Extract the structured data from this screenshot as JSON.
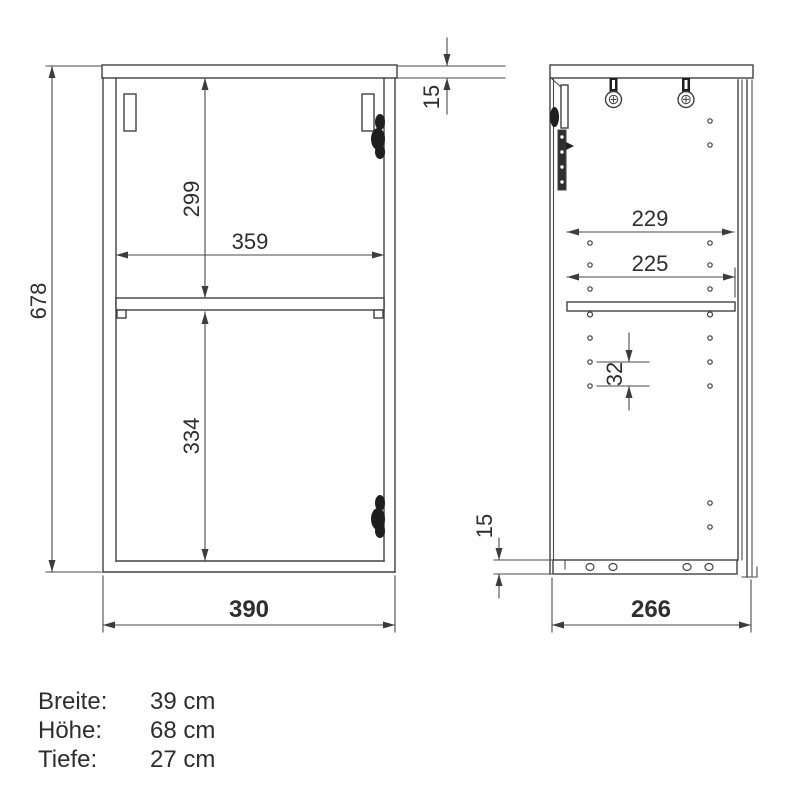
{
  "front_view": {
    "dims": {
      "height": "678",
      "top_panel": "15",
      "upper_section": "299",
      "inner_width": "359",
      "lower_section": "334",
      "width": "390"
    }
  },
  "side_view": {
    "dims": {
      "upper_depth": "229",
      "shelf_depth": "225",
      "hole_spacing": "32",
      "bottom_panel": "15",
      "depth": "266"
    }
  },
  "specs": {
    "rows": [
      {
        "label": "Breite:",
        "value": "39 cm"
      },
      {
        "label": "Höhe:",
        "value": "68 cm"
      },
      {
        "label": "Tiefe:",
        "value": "27 cm"
      }
    ]
  },
  "colors": {
    "line": "#414141",
    "text": "#2e2e2e",
    "background": "#ffffff"
  }
}
